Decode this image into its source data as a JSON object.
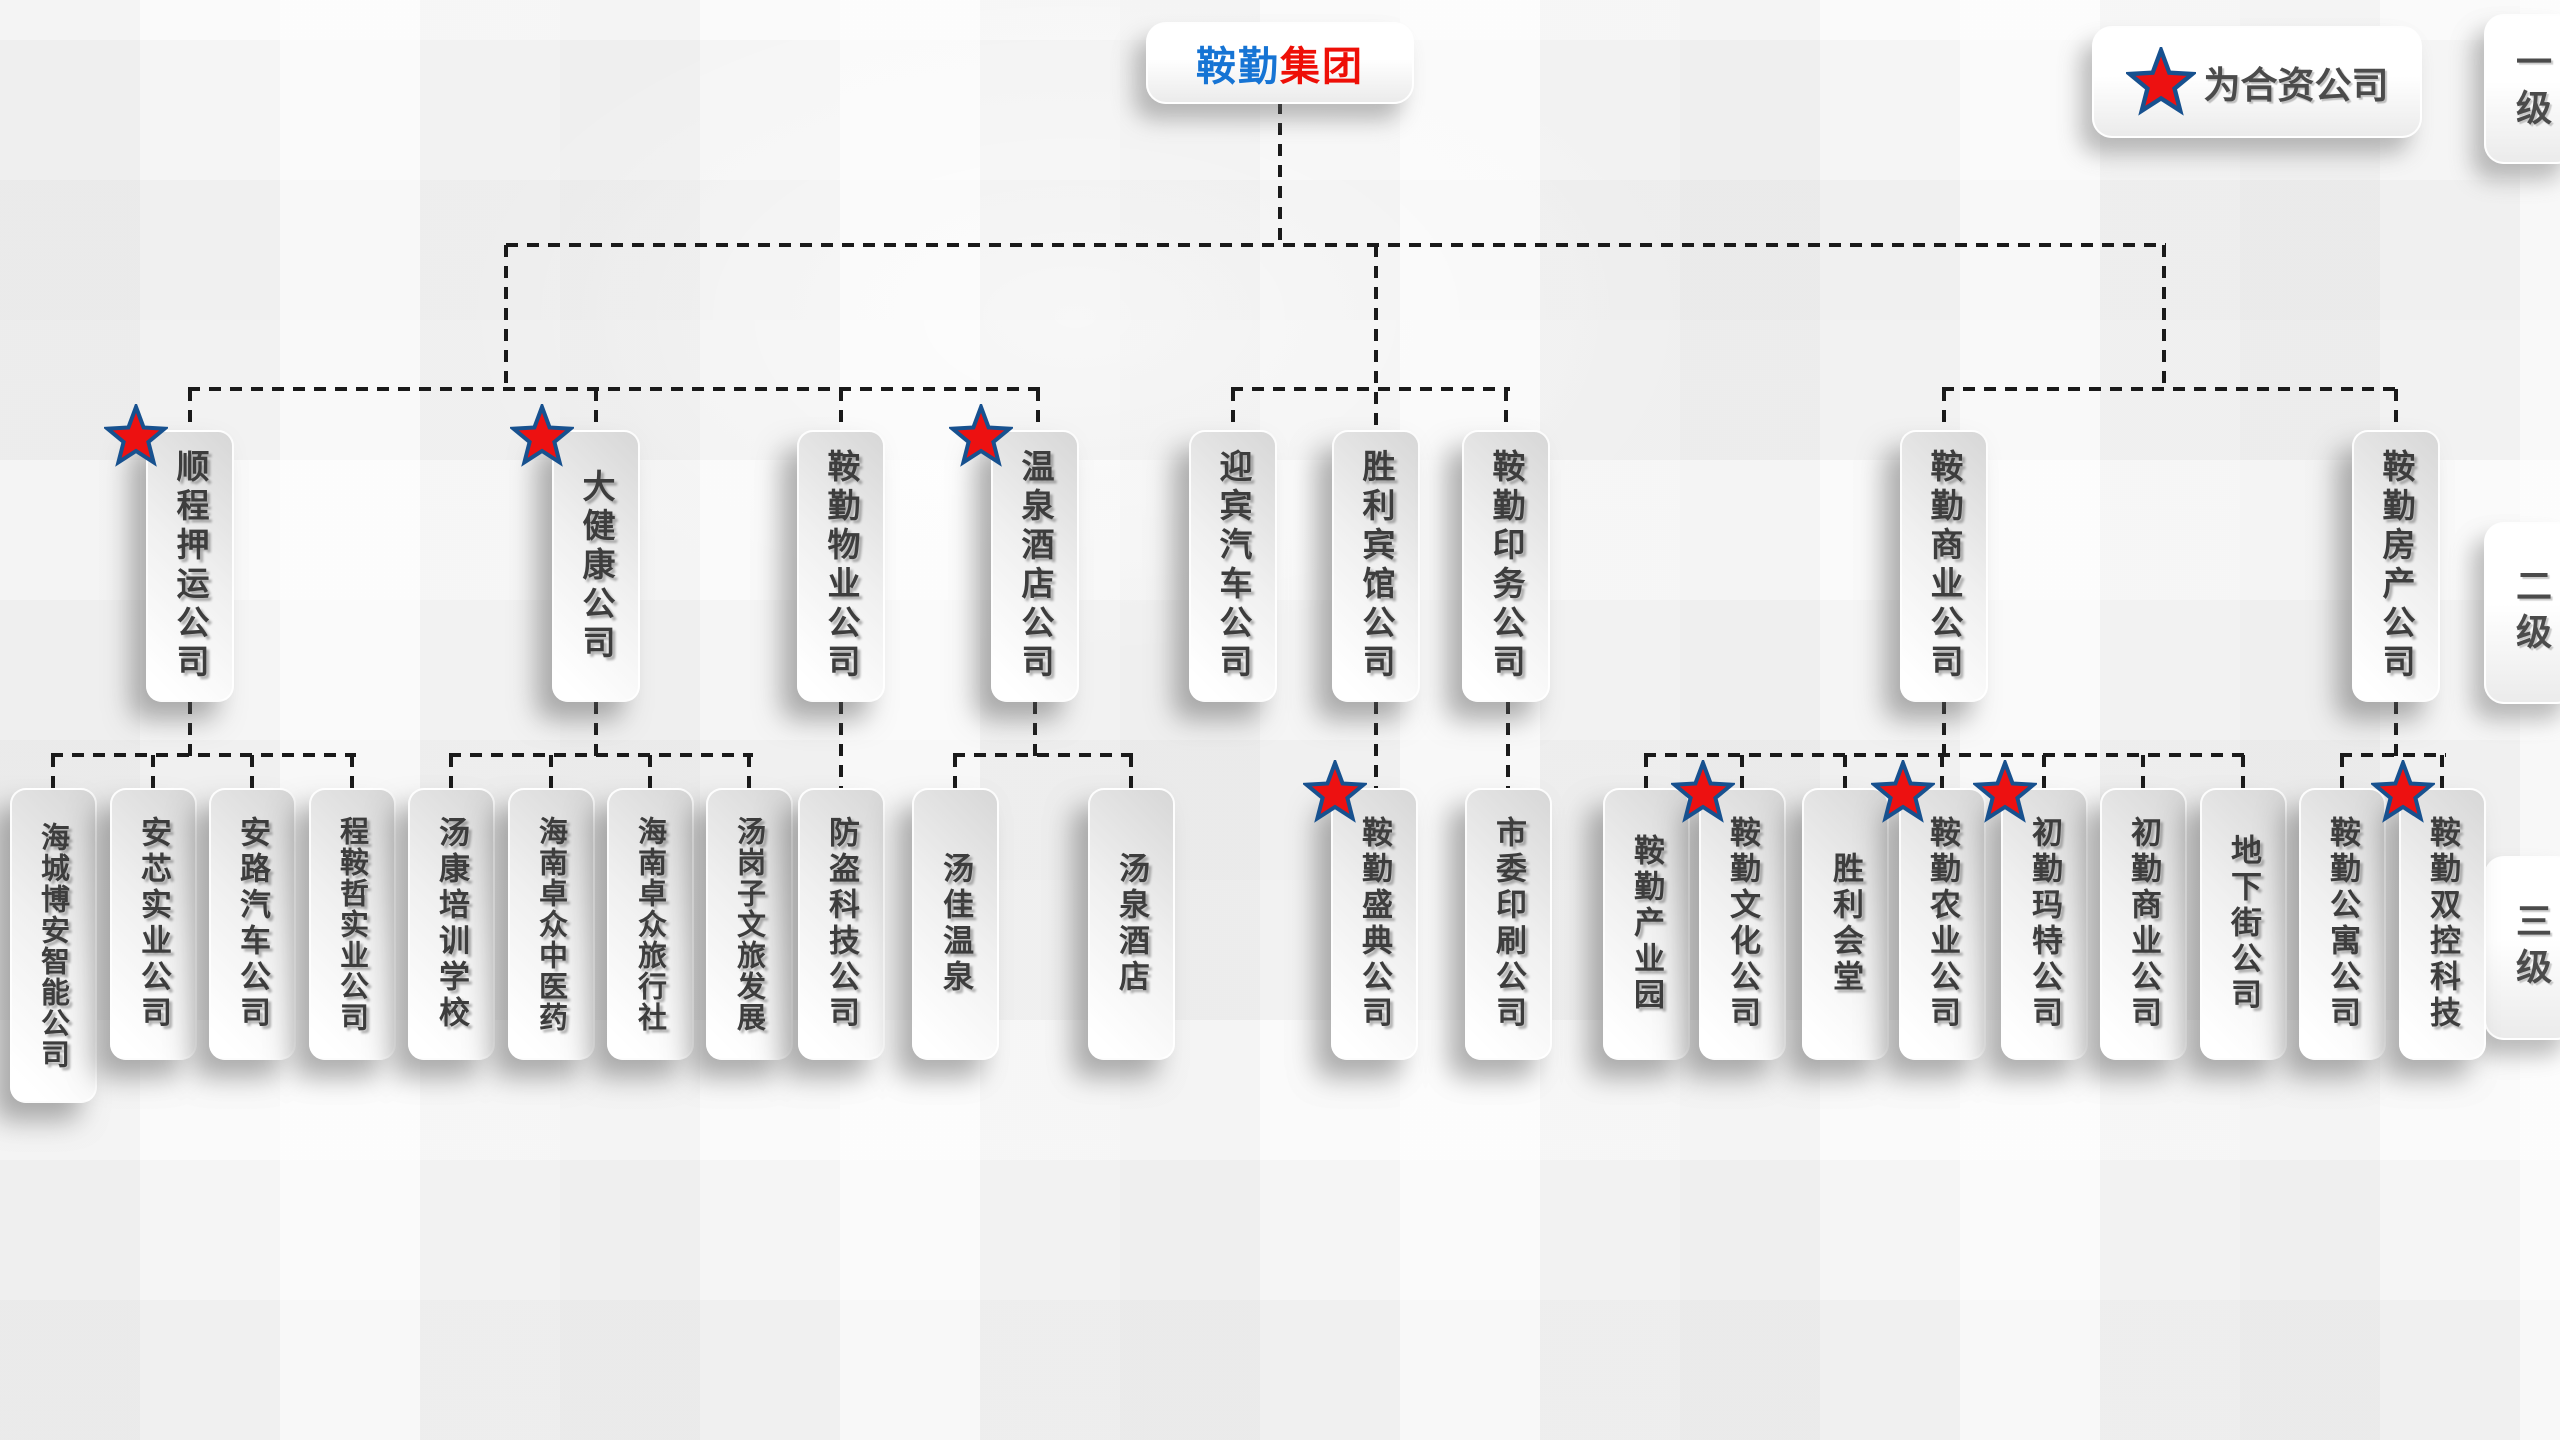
{
  "root": {
    "name_blue": "鞍勤",
    "name_red": "集团"
  },
  "legend": {
    "star_icon": "red-star",
    "label": "为合资公司"
  },
  "level_labels": {
    "level1": "一级",
    "level2": "二级",
    "level3": "三级"
  },
  "colors": {
    "title_blue": "#1674d4",
    "title_red": "#ee0f07",
    "star_fill": "#ed1111",
    "star_border": "#17518f",
    "node_text": "#3d3d3d",
    "line": "#1a1a1a"
  },
  "level2": [
    {
      "label": "顺程押运公司",
      "joint_venture": true
    },
    {
      "label": "大健康公司",
      "joint_venture": true
    },
    {
      "label": "鞍勤物业公司",
      "joint_venture": false
    },
    {
      "label": "温泉酒店公司",
      "joint_venture": true
    },
    {
      "label": "迎宾汽车公司",
      "joint_venture": false
    },
    {
      "label": "胜利宾馆公司",
      "joint_venture": false
    },
    {
      "label": "鞍勤印务公司",
      "joint_venture": false
    },
    {
      "label": "鞍勤商业公司",
      "joint_venture": false
    },
    {
      "label": "鞍勤房产公司",
      "joint_venture": false
    }
  ],
  "level3": [
    {
      "label": "海城博安智能公司",
      "joint_venture": false,
      "parent": "顺程押运公司"
    },
    {
      "label": "安芯实业公司",
      "joint_venture": false,
      "parent": "顺程押运公司"
    },
    {
      "label": "安路汽车公司",
      "joint_venture": false,
      "parent": "顺程押运公司"
    },
    {
      "label": "程鞍哲实业公司",
      "joint_venture": false,
      "parent": "顺程押运公司"
    },
    {
      "label": "汤康培训学校",
      "joint_venture": false,
      "parent": "大健康公司"
    },
    {
      "label": "海南卓众中医药",
      "joint_venture": false,
      "parent": "大健康公司"
    },
    {
      "label": "海南卓众旅行社",
      "joint_venture": false,
      "parent": "大健康公司"
    },
    {
      "label": "汤岗子文旅发展",
      "joint_venture": false,
      "parent": "大健康公司"
    },
    {
      "label": "防盗科技公司",
      "joint_venture": false,
      "parent": "鞍勤物业公司"
    },
    {
      "label": "汤佳温泉",
      "joint_venture": false,
      "parent": "温泉酒店公司"
    },
    {
      "label": "汤泉酒店",
      "joint_venture": false,
      "parent": "温泉酒店公司"
    },
    {
      "label": "鞍勤盛典公司",
      "joint_venture": true,
      "parent": "胜利宾馆公司"
    },
    {
      "label": "市委印刷公司",
      "joint_venture": false,
      "parent": "鞍勤印务公司"
    },
    {
      "label": "鞍勤产业园",
      "joint_venture": false,
      "parent": "鞍勤商业公司"
    },
    {
      "label": "鞍勤文化公司",
      "joint_venture": true,
      "parent": "鞍勤商业公司"
    },
    {
      "label": "胜利会堂",
      "joint_venture": false,
      "parent": "鞍勤商业公司"
    },
    {
      "label": "鞍勤农业公司",
      "joint_venture": true,
      "parent": "鞍勤商业公司"
    },
    {
      "label": "初勤玛特公司",
      "joint_venture": true,
      "parent": "鞍勤商业公司"
    },
    {
      "label": "初勤商业公司",
      "joint_venture": false,
      "parent": "鞍勤商业公司"
    },
    {
      "label": "地下街公司",
      "joint_venture": false,
      "parent": "鞍勤商业公司"
    },
    {
      "label": "鞍勤公寓公司",
      "joint_venture": false,
      "parent": "鞍勤房产公司"
    },
    {
      "label": "鞍勤双控科技",
      "joint_venture": true,
      "parent": "鞍勤房产公司"
    }
  ]
}
